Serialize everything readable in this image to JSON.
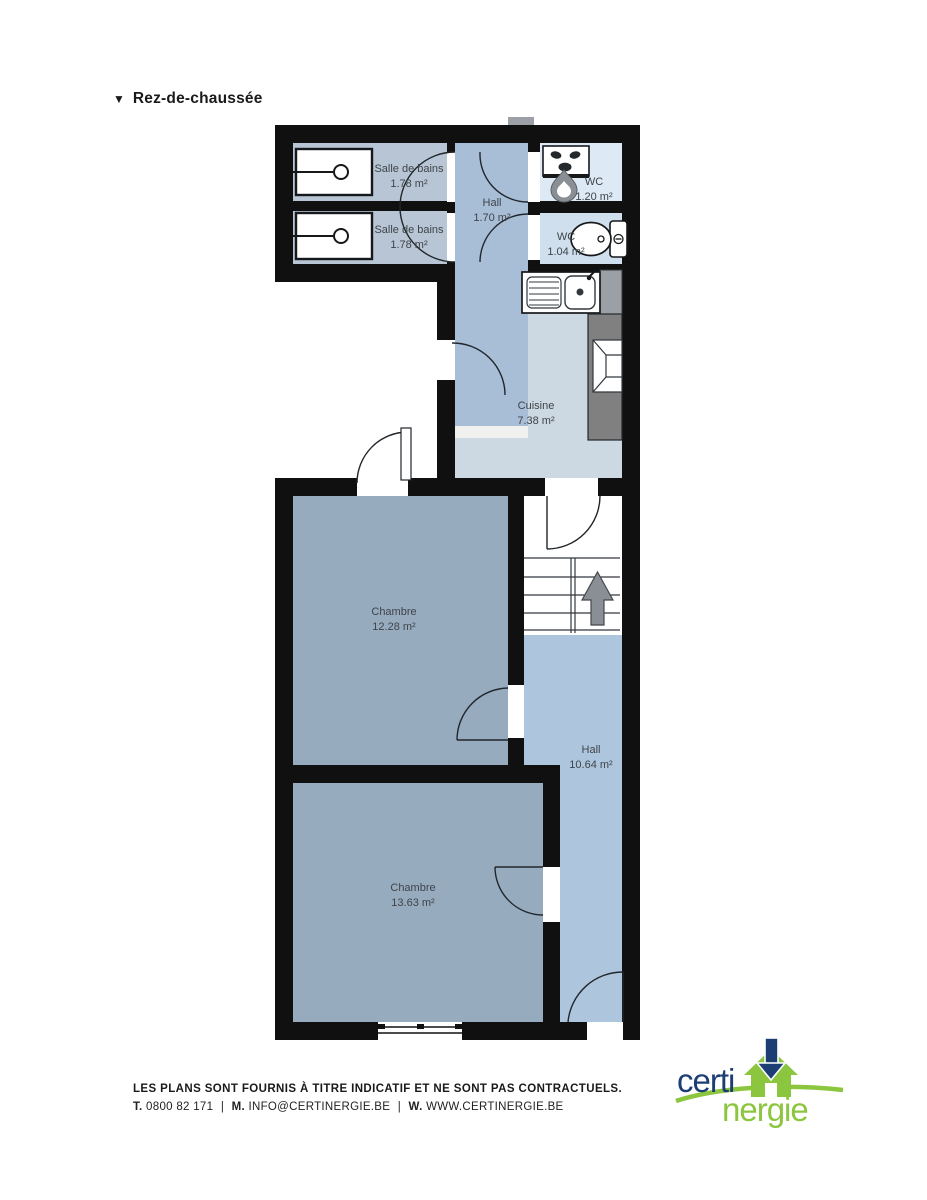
{
  "title": {
    "marker": "▼",
    "text": "Rez-de-chaussée"
  },
  "rooms": {
    "sdb1": {
      "name": "Salle de bains",
      "area": "1.78 m²"
    },
    "sdb2": {
      "name": "Salle de bains",
      "area": "1.78 m²"
    },
    "hall1": {
      "name": "Hall",
      "area": "1.70 m²"
    },
    "wc1": {
      "name": "WC",
      "area": "1.20 m²"
    },
    "wc2": {
      "name": "WC",
      "area": "1.04 m²"
    },
    "cuisine": {
      "name": "Cuisine",
      "area": "7.38 m²"
    },
    "chambre1": {
      "name": "Chambre",
      "area": "12.28 m²"
    },
    "hall2": {
      "name": "Hall",
      "area": "10.64 m²"
    },
    "chambre2": {
      "name": "Chambre",
      "area": "13.63 m²"
    }
  },
  "colors": {
    "wall": "#101010",
    "salle_de_bains_floor": "#b7c5d5",
    "corridor_floor": "#a8bdd6",
    "wc1_floor": "#dde9f4",
    "wc2_floor": "#cfdfee",
    "cuisine_floor": "#ccd8e2",
    "chambre_floor": "#97abbf",
    "hall_floor": "#aec6dd",
    "counter_gray": "#808080",
    "fixture_gray": "#9aa0a6",
    "logo_blue": "#1c3e75",
    "logo_green": "#8cc63e"
  },
  "footer": {
    "disclaimer": "LES PLANS SONT FOURNIS À TITRE INDICATIF ET NE SONT PAS CONTRACTUELS.",
    "contact": {
      "t_label": "T.",
      "phone": "0800 82 171",
      "m_label": "M.",
      "email": "INFO@CERTINERGIE.BE",
      "w_label": "W.",
      "web": "WWW.CERTINERGIE.BE",
      "sep": "|"
    },
    "logo": {
      "part1": "certi",
      "part2": "nergie"
    }
  }
}
